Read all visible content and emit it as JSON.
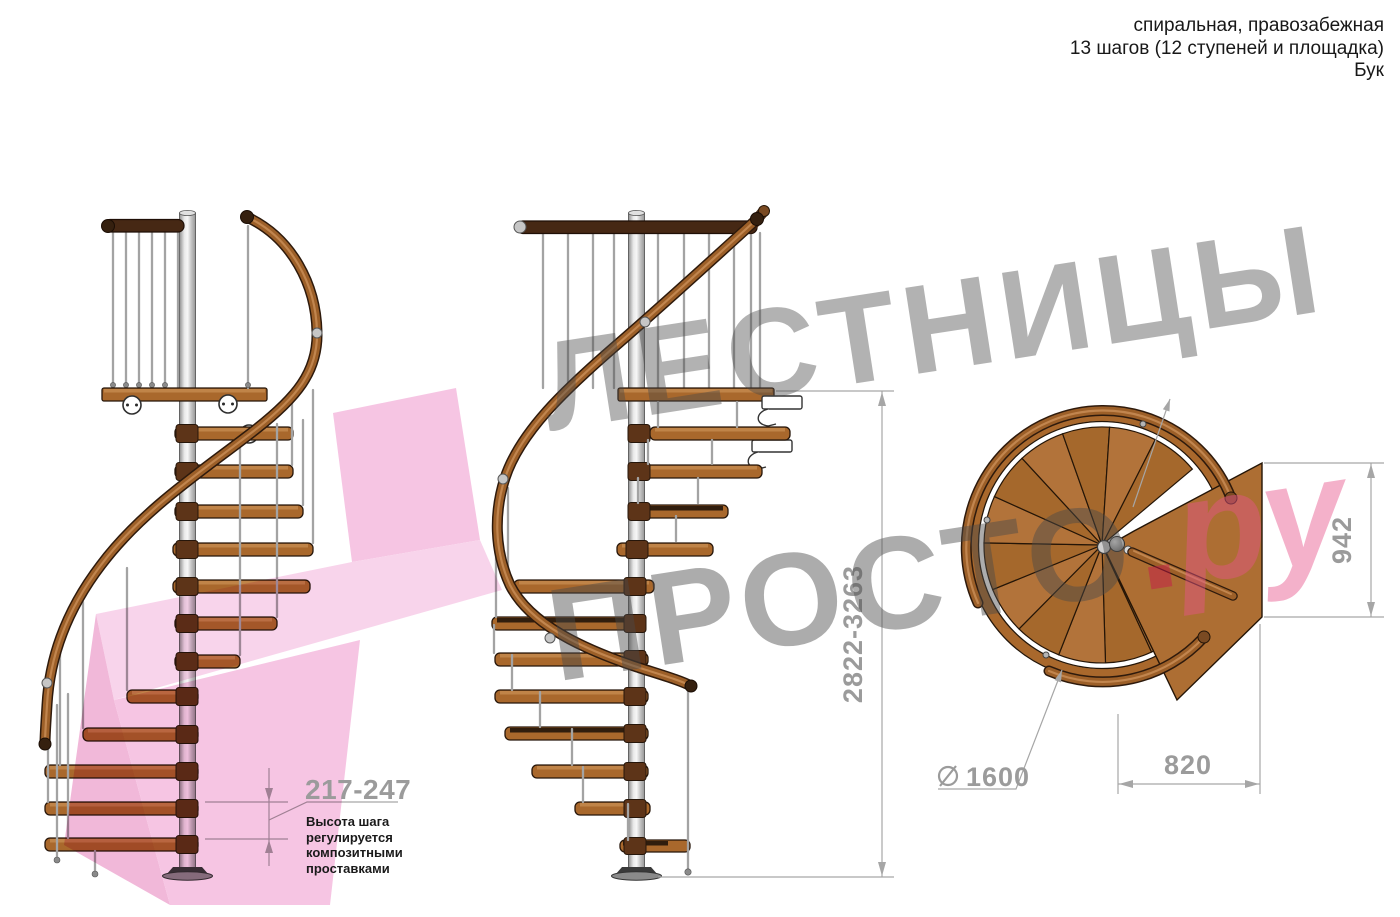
{
  "header": {
    "line1": "спиральная, правозабежная",
    "line2": "13 шагов (12 ступеней и площадка)",
    "line3": "Бук"
  },
  "watermark": {
    "word1": "ЛЕСТНИЦЫ",
    "word2": "ПРОСТО",
    "dot": ".",
    "suffix": "ру"
  },
  "dimensions": {
    "total_height": "2822-3263",
    "step_height": "217-247",
    "note_lines": [
      "Высота шага",
      "регулируется",
      "композитными",
      "проставками"
    ],
    "plan_depth": "942",
    "plan_width": "820",
    "diameter": "1600"
  },
  "colors": {
    "wood": "#a9682c",
    "wood_light": "#c08448",
    "rail": "#9c5f28",
    "dark_rail": "#462814",
    "metal": "#c9c9c9",
    "dimension_gray": "#9b9b9b",
    "watermark_gray": "#a8a8a8",
    "watermark_pink": "#e8548c",
    "arrow_pink": "#f3aed8"
  }
}
